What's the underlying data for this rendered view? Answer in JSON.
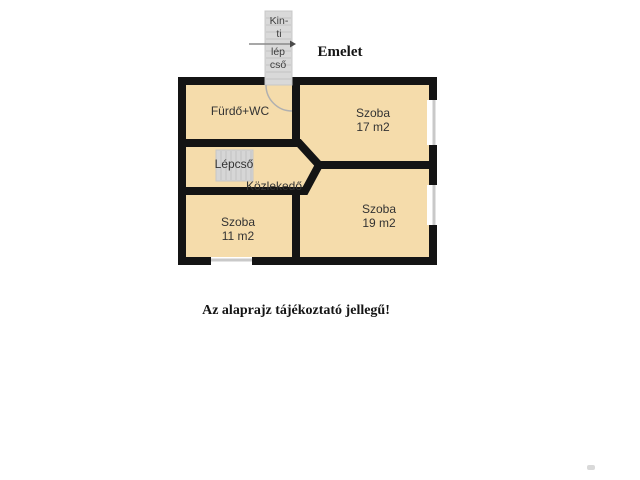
{
  "title": "Emelet",
  "disclaimer": "Az alaprajz tájékoztató jellegű!",
  "outdoor_stairs": {
    "label_line1": "Kin-\nti",
    "label_line2": "lép\ncső"
  },
  "rooms": {
    "bathroom": {
      "label": "Fürdő+WC"
    },
    "room17": {
      "label": "Szoba\n17 m2",
      "name": "Szoba",
      "area": "17 m2"
    },
    "stairs": {
      "label": "Lépcső"
    },
    "hallway": {
      "label": "Közlekedő"
    },
    "room11": {
      "label": "Szoba\n11 m2",
      "name": "Szoba",
      "area": "11 m2"
    },
    "room19": {
      "label": "Szoba\n19 m2",
      "name": "Szoba",
      "area": "19 m2"
    }
  },
  "colors": {
    "room-fill": "#f5dcab",
    "wall": "#141414",
    "stairs-fill": "#d9d9d9",
    "stairs-tread": "#c3c3c3",
    "window-line": "#c9c9c9",
    "door-arc": "#b0b0b0",
    "label": "#333333"
  }
}
